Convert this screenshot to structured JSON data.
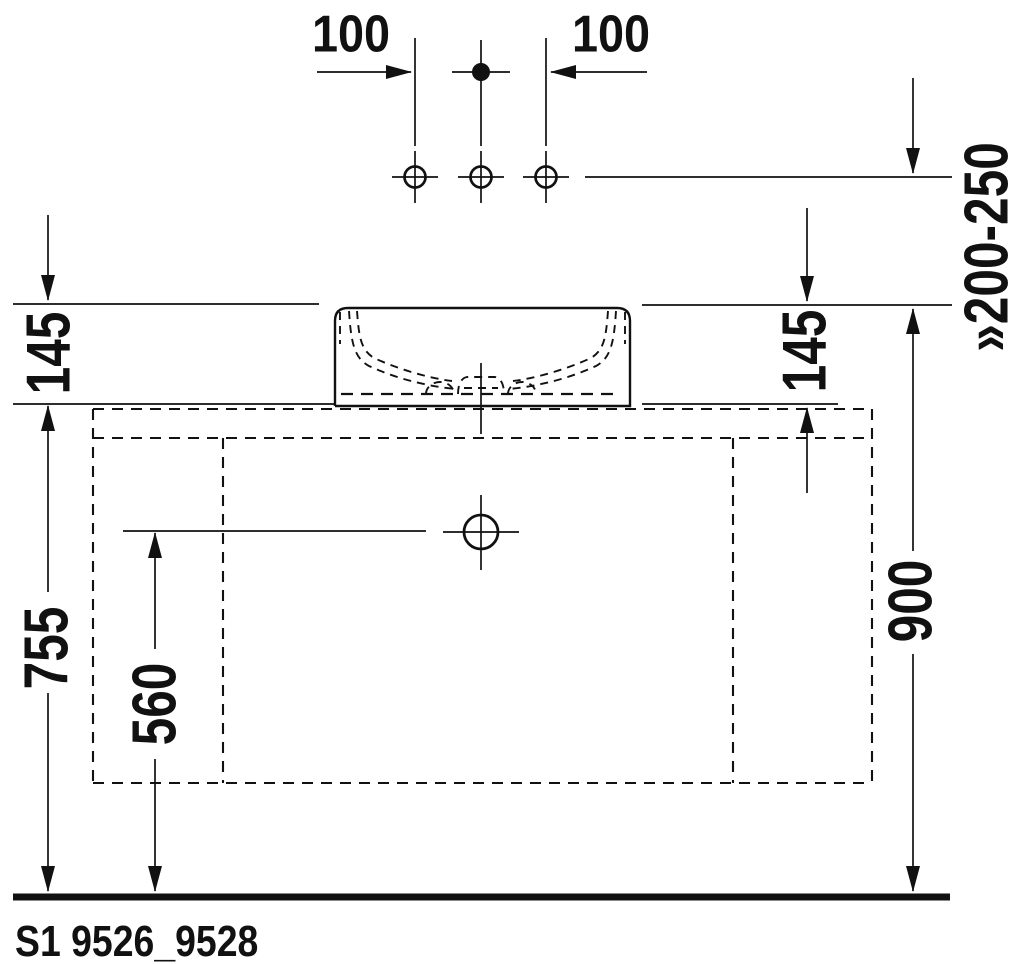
{
  "drawing": {
    "code": "S1 9526_9528",
    "colors": {
      "line": "#111111",
      "background": "#ffffff"
    },
    "dimensions": {
      "hole_offset_left": "100",
      "hole_offset_right": "100",
      "faucet_height_range": "»200-250",
      "basin_height_left": "145",
      "basin_height_right": "145",
      "countertop_height": "755",
      "drain_height": "560",
      "rim_height": "900"
    }
  }
}
